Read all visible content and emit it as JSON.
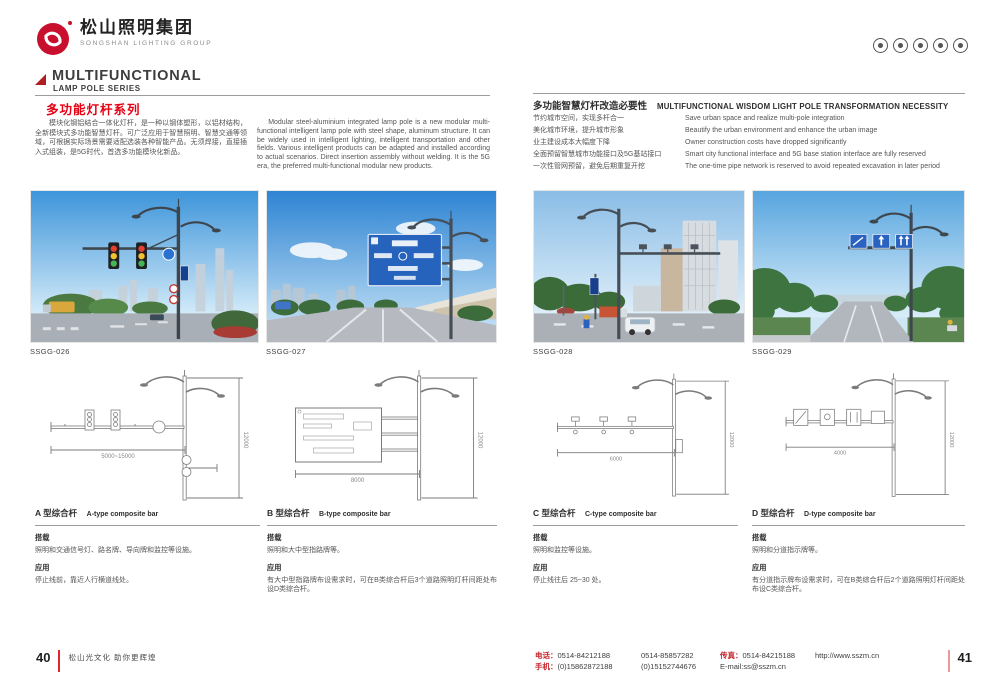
{
  "brand": {
    "logo_cn": "松山照明集团",
    "logo_en": "SONGSHAN LIGHTING GROUP"
  },
  "cert_icons": [
    "cert-badge-1",
    "cert-badge-2",
    "cert-badge-3",
    "cert-badge-4",
    "cert-badge-5"
  ],
  "left_header": {
    "en1": "MULTIFUNCTIONAL",
    "en2": "LAMP POLE SERIES",
    "cn": "多功能灯杆系列"
  },
  "intro": {
    "cn": "模块化钢铝结合一体化灯杆，是一种以钢体塑形，以铝材结构，全新模块式多功能智慧灯杆。可广泛应用于智慧照明、智慧交通等领域，可根据实际场景需要适配选装各种智能产品。无须焊接，直接插入式组装，是5G时代，首选多功能模块化新品。",
    "en": "Modular steel-aluminium integrated lamp pole is a new modular multi-functional intelligent lamp pole with steel shape, aluminum structure. It can be widely used in intelligent lighting, intelligent transportation and other fields. Various intelligent products can be adapted and installed according to actual scenarios. Direct insertion assembly without welding. It is the 5G era, the preferred multi-functional modular new products."
  },
  "necessity": {
    "cn": "多功能智慧灯杆改造必要性",
    "en": "MULTIFUNCTIONAL WISDOM LIGHT POLE TRANSFORMATION NECESSITY",
    "rows": [
      {
        "cn": "节约城市空间，实现多杆合一",
        "en": "Save urban space and realize multi-pole integration"
      },
      {
        "cn": "美化城市环境，提升城市形象",
        "en": "Beautify the urban environment and enhance the urban image"
      },
      {
        "cn": "业主建设成本大幅度下降",
        "en": "Owner construction costs have dropped significantly"
      },
      {
        "cn": "全面预留智慧城市功能接口及5G基站接口",
        "en": "Smart city functional interface and 5G base station interface are fully reserved"
      },
      {
        "cn": "一次性管网预留，避免后期重复开挖",
        "en": "The one-time pipe network is reserved to avoid repeated excavation in later period"
      }
    ]
  },
  "photos": [
    {
      "code": "SSGG-026"
    },
    {
      "code": "SSGG-027"
    },
    {
      "code": "SSGG-028"
    },
    {
      "code": "SSGG-029"
    }
  ],
  "labels": {
    "carry": "搭载",
    "app": "应用"
  },
  "products": [
    {
      "cn": "A 型综合杆",
      "en": "A-type composite bar",
      "carry": "照明和交通信号灯、路名牌、导向牌和监控等设施。",
      "app": "停止线前，靠近人行横道线处。",
      "dim_w": "5000~15000",
      "dim_h": "12000"
    },
    {
      "cn": "B 型综合杆",
      "en": "B-type composite bar",
      "carry": "照明和大中型指路牌等。",
      "app": "有大中型指路牌布设需求时，可在B类综合杆后3个道路照明灯杆间距处布设D类综合杆。",
      "dim_w": "8000",
      "dim_h": "12000"
    },
    {
      "cn": "C 型综合杆",
      "en": "C-type composite bar",
      "carry": "照明和监控等设施。",
      "app": "停止线往后 25~30 处。",
      "dim_w": "6000",
      "dim_h": "12000"
    },
    {
      "cn": "D 型综合杆",
      "en": "D-type composite bar",
      "carry": "照明和分道指示牌等。",
      "app": "有分道指示牌布设需求时，可在B类综合杆后2个道路照明灯杆间距处布设C类综合杆。",
      "dim_w": "4000",
      "dim_h": "12000"
    }
  ],
  "footer": {
    "page_left": "40",
    "slogan": "松山光文化  助你更辉煌",
    "tel_label": "电话：",
    "tel1": "0514-84212188",
    "tel2": "0514-85857282",
    "fax_label": "传真：",
    "fax": "0514-84215188",
    "site": "http://www.sszm.cn",
    "mob_label": "手机：",
    "mob1": "(0)15862872188",
    "mob2": "(0)15152744676",
    "email": "E-mail:ss@sszm.cn",
    "page_right": "41"
  },
  "colors": {
    "brand_red": "#c8102e",
    "accent_red": "#e60012",
    "sign_blue": "#2563bd"
  }
}
